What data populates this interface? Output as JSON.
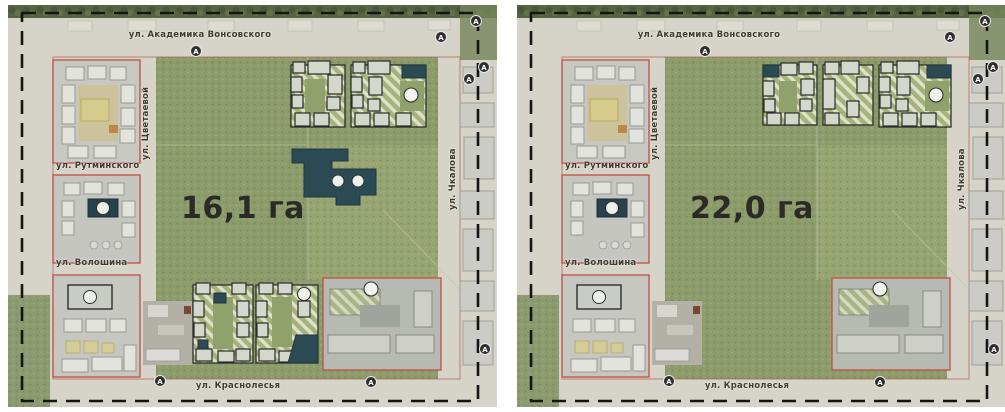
{
  "streets": {
    "akademika_vonsovskogo": "ул. Академика Вонсовского",
    "tsvetaevoy": "ул. Цветаевой",
    "rutminskogo": "ул. Рутминского",
    "voloshina": "ул. Волошина",
    "chkalova": "ул. Чкалова",
    "krasnolesya": "ул. Краснолесья"
  },
  "panels": [
    {
      "area_label": "16,1 га"
    },
    {
      "area_label": "22,0 га"
    }
  ],
  "markers": {
    "bus_stop_letter": "А"
  },
  "colors": {
    "forest": "#8c9c6b",
    "planned_dark_building": "#2c4a54",
    "block_outline_red": "#b5544a",
    "boundary_dash": "#141414",
    "area_text": "#2b2a27"
  }
}
